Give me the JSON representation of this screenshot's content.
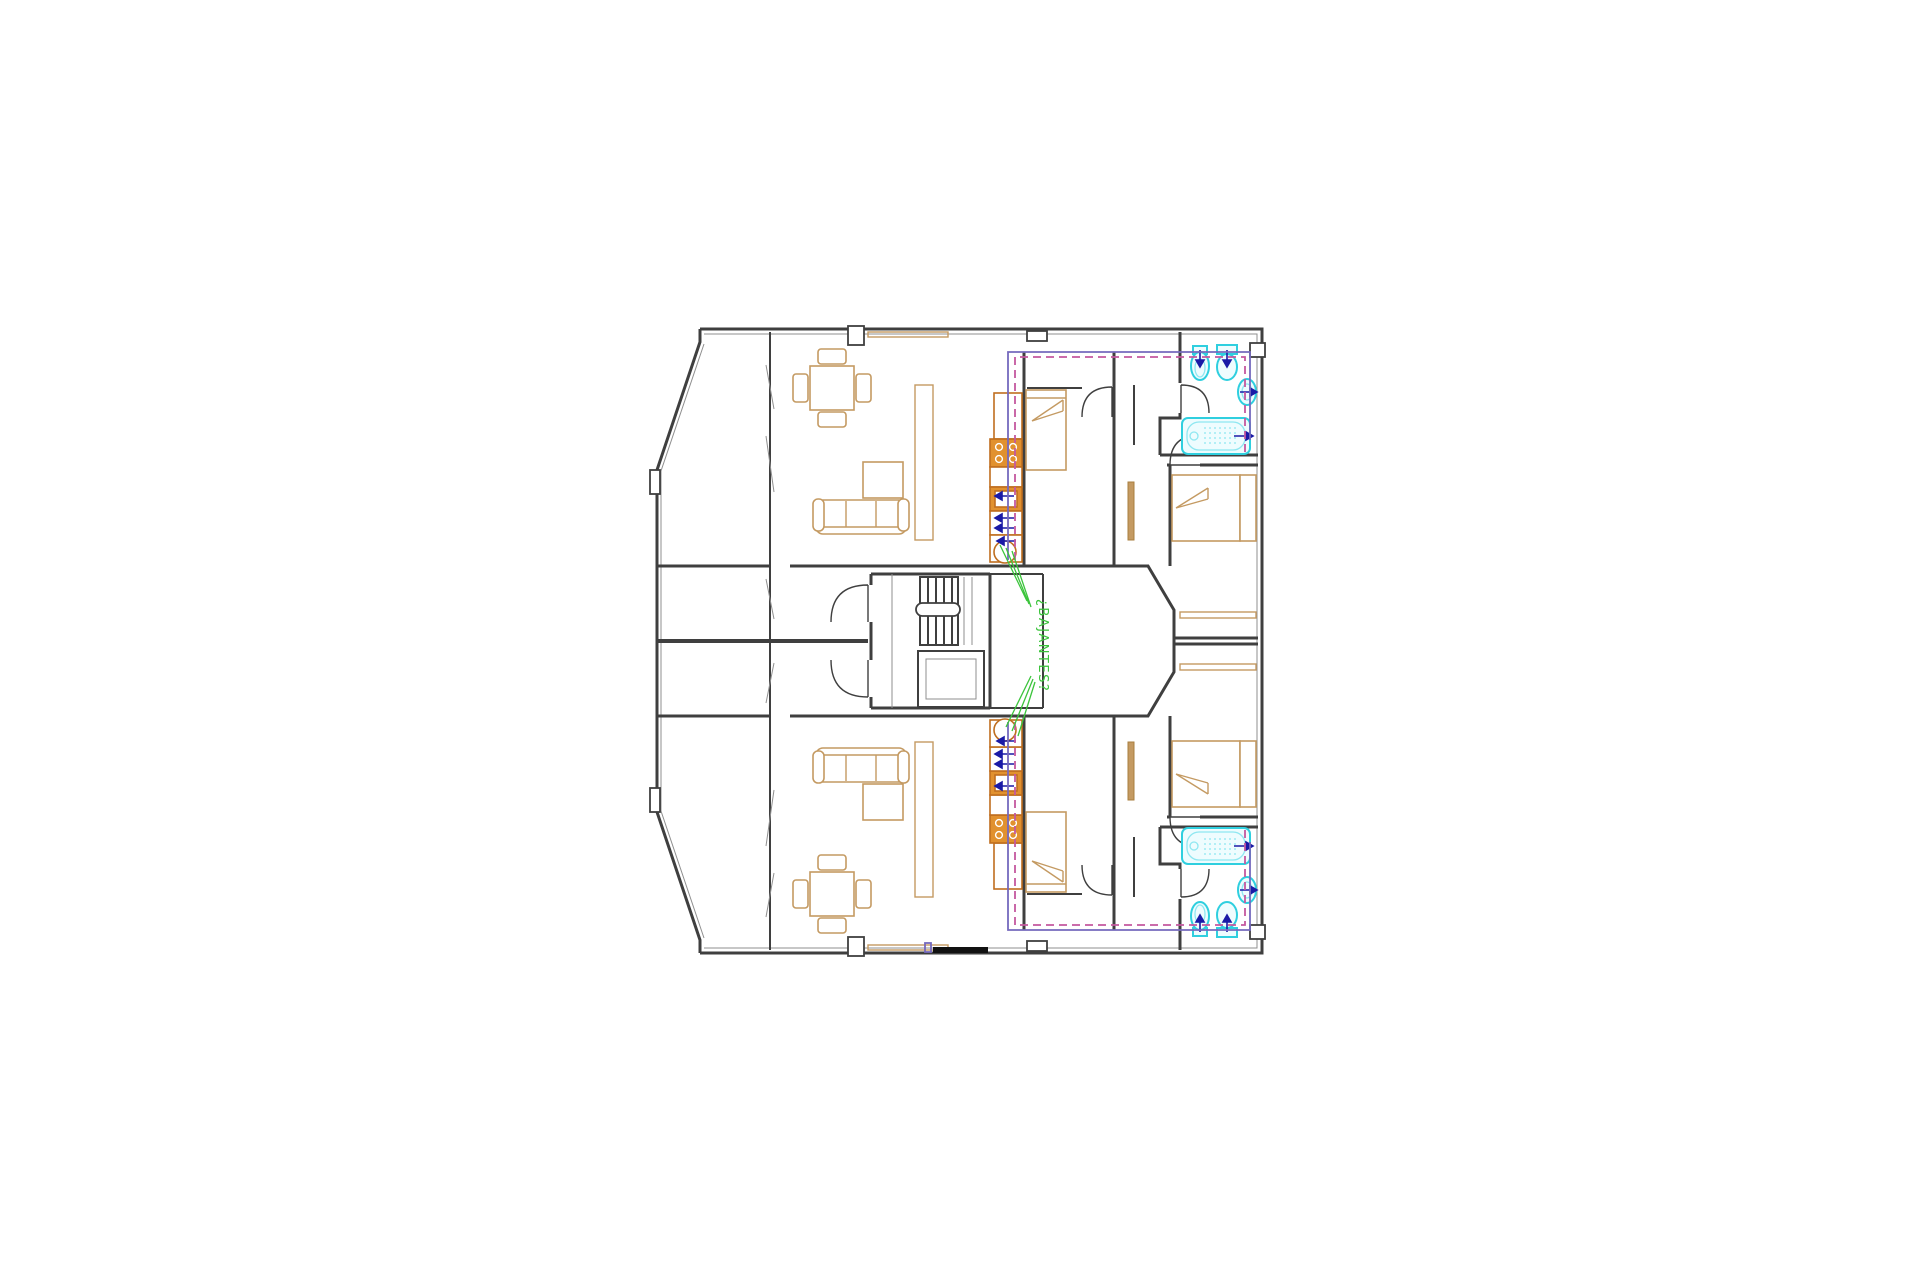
{
  "annotation": {
    "label": "¿BAJANTES?"
  },
  "theme": {
    "background": "#ffffff",
    "wall": "#3f3f3f",
    "wall_light": "#8f8f8f",
    "furniture": "#c49a62",
    "furniture_dark": "#a97f3f",
    "kitchen": "#bf6e1f",
    "kitchen_fill": "#e1912f",
    "fixture": "#2fcfdf",
    "fixture_light": "#8fe7f1",
    "fixture_fill": "#eefcfe",
    "zone_solid": "#7569bd",
    "zone_dashed": "#c4589f",
    "arrow": "#1a1aa6",
    "leader": "#3cc43c"
  },
  "plan": {
    "apartments": [
      {
        "name": "apartment-top",
        "rooms": [
          "terrace",
          "living-dining",
          "kitchen",
          "bedroom-1",
          "bedroom-2",
          "corridor",
          "bathroom"
        ]
      },
      {
        "name": "apartment-bottom",
        "rooms": [
          "terrace",
          "living-dining",
          "kitchen",
          "bedroom-1",
          "bedroom-2",
          "corridor",
          "bathroom"
        ]
      }
    ],
    "core": [
      "landing",
      "stairs",
      "elevator",
      "services-duct",
      "light-well"
    ],
    "bathroom_fixtures": [
      "bathtub",
      "washbasin",
      "toilet",
      "bidet"
    ],
    "kitchen_fixtures": [
      "cooktop",
      "sink-unit",
      "round-sink",
      "base-cabinets"
    ],
    "furniture": [
      "dining-table-4-chairs",
      "sofa",
      "coffee-table",
      "shelf-partition",
      "single-bed",
      "double-bed",
      "wardrobe"
    ]
  }
}
